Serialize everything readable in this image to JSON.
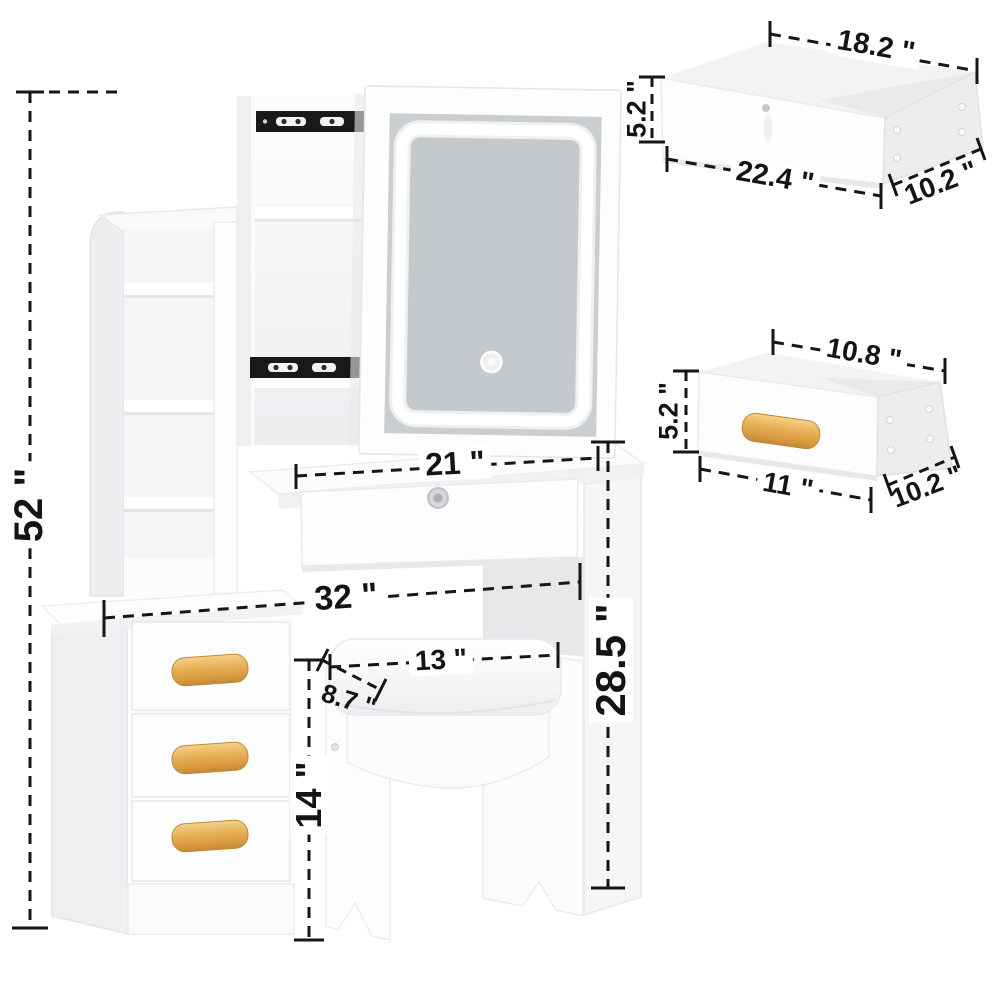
{
  "image_type": "product dimension diagram",
  "subject": "White vanity dressing table set with sliding LED mirror, hidden storage, side shelf tower, 3-drawer cabinet and cushioned stool",
  "units": "inches",
  "colors": {
    "background": "#ffffff",
    "furniture_white": "#fdfdfe",
    "shade_gray": "#ececee",
    "mirror_glass": "#c9cdd1",
    "led_ring": "#ffffff",
    "slide_rail_black": "#191919",
    "wood_handle": "#e2ab55",
    "dimension_ink": "#161616"
  },
  "main_unit": {
    "overall_height": "52 \"",
    "desktop_width": "21 \"",
    "overall_width": "32 \"",
    "desk_height": "28.5 \"",
    "cabinet_height": "14 \"",
    "stool_seat_width": "13 \"",
    "stool_seat_depth": "8.7 \""
  },
  "large_drawer_detail": {
    "top_inner_width": "18.2 \"",
    "height": "5.2 \"",
    "front_width": "22.4 \"",
    "side_depth": "10.2 \""
  },
  "small_drawer_detail": {
    "top_inner_width": "10.8 \"",
    "height": "5.2 \"",
    "front_width": "11 \"",
    "side_depth": "10.2 \""
  }
}
